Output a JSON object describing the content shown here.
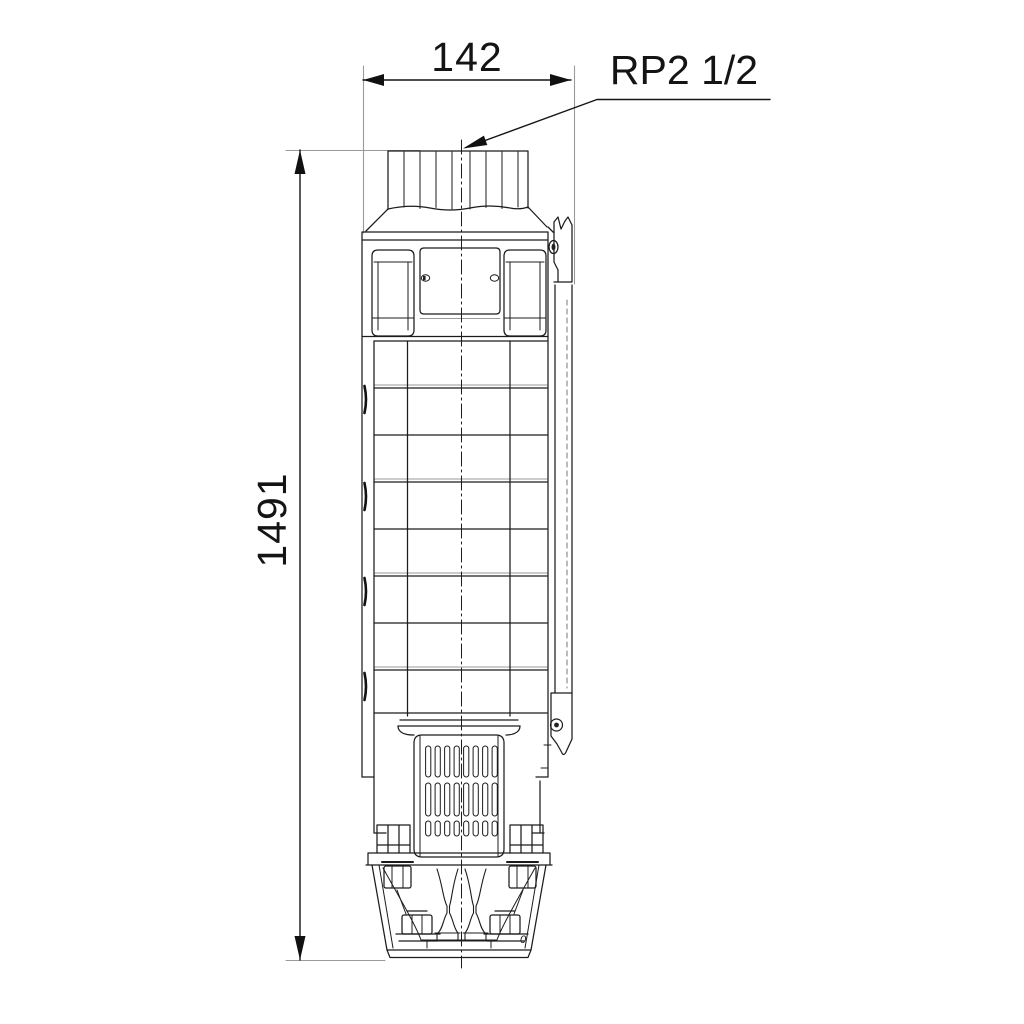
{
  "labels": {
    "width_mm": "142",
    "height_mm": "1491",
    "connection": "RP2 1/2",
    "stray_mark": "0"
  },
  "colors": {
    "line": "#1c1c1c",
    "light_line": "#9a9a9a",
    "background": "#ffffff"
  }
}
